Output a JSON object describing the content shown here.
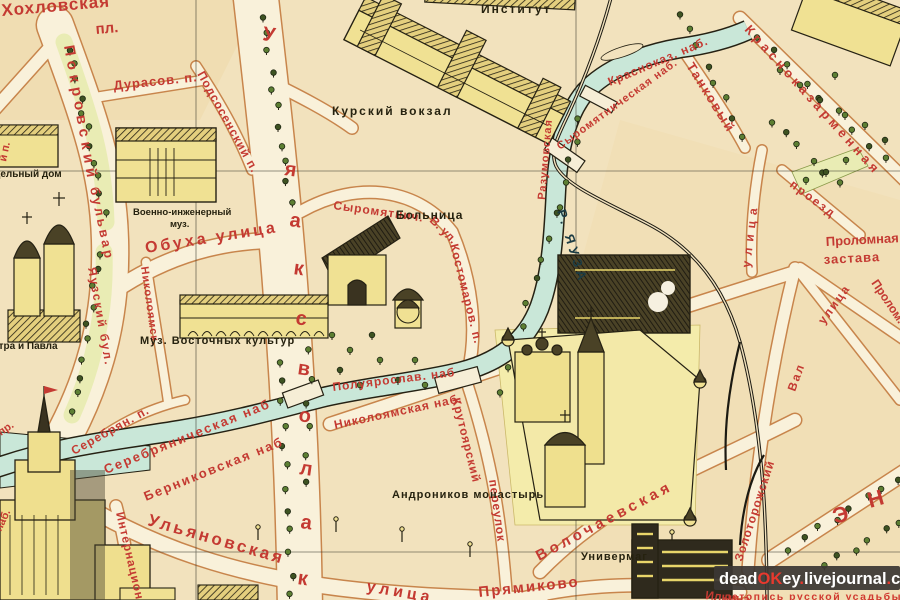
{
  "colors": {
    "paper": "#f2e2bd",
    "street_fill": "#f9f1da",
    "street_edge": "#c8854c",
    "river": "#c9e7d8",
    "ink": "#252113",
    "park": "#e9ecb4",
    "tree": "#5d7f33",
    "building": "#f0e193",
    "label_red": "#c43a32",
    "label_black": "#26220f",
    "label_blue": "#1c3c44",
    "watermark_bg": "#3b3734",
    "watermark_red": "#e8392e",
    "watermark_white": "#ffffff"
  },
  "labels": [
    {
      "t": "Хохловская",
      "x": 2,
      "y": 16,
      "s": 17,
      "r": -5,
      "ls": 1
    },
    {
      "t": "пл.",
      "x": 96,
      "y": 34,
      "s": 15,
      "r": -5
    },
    {
      "t": "Покровский",
      "x": 64,
      "y": 46,
      "s": 15,
      "r": 80,
      "ls": 5
    },
    {
      "t": "бульвар",
      "x": 90,
      "y": 188,
      "s": 13,
      "r": 78,
      "ls": 3
    },
    {
      "t": "Дурасов. п.",
      "x": 114,
      "y": 90,
      "s": 13,
      "r": -6,
      "ls": 1
    },
    {
      "t": "Подсосенский п.",
      "x": 197,
      "y": 74,
      "s": 12,
      "r": 61,
      "ls": 1
    },
    {
      "t": "й п.",
      "x": 6,
      "y": 162,
      "s": 11,
      "r": -78
    },
    {
      "t": "одельный дом",
      "x": -12,
      "y": 177,
      "s": 10,
      "c": "black"
    },
    {
      "t": "Военно-инженерный",
      "x": 133,
      "y": 215,
      "s": 9.5,
      "c": "black"
    },
    {
      "t": "муз.",
      "x": 170,
      "y": 227,
      "s": 9.5,
      "c": "black"
    },
    {
      "t": "Обуха улица",
      "x": 146,
      "y": 253,
      "s": 16,
      "r": -9,
      "ls": 3
    },
    {
      "t": "Николоямск.",
      "x": 141,
      "y": 267,
      "s": 11,
      "r": 82,
      "ls": 1
    },
    {
      "t": "Яузский бул.",
      "x": 88,
      "y": 268,
      "s": 12,
      "r": 80,
      "ls": 2
    },
    {
      "t": "Петра и Павла",
      "x": -14,
      "y": 349,
      "s": 10,
      "c": "black"
    },
    {
      "t": "Муз. Восточных культур",
      "x": 140,
      "y": 344,
      "s": 11,
      "c": "black",
      "ls": 1
    },
    {
      "t": "пр.",
      "x": 1,
      "y": 436,
      "s": 11,
      "r": -35
    },
    {
      "t": "Серебрян. п.",
      "x": 74,
      "y": 455,
      "s": 12,
      "r": -29,
      "ls": 1
    },
    {
      "t": "Серебряническая наб",
      "x": 106,
      "y": 474,
      "s": 13,
      "r": -22,
      "ls": 2
    },
    {
      "t": "Берниковская наб",
      "x": 146,
      "y": 501,
      "s": 13,
      "r": -22,
      "ls": 2
    },
    {
      "t": "наб.",
      "x": 1,
      "y": 532,
      "s": 11,
      "r": -65
    },
    {
      "t": "Интернацион.",
      "x": 116,
      "y": 513,
      "s": 12,
      "r": 77,
      "ls": 1
    },
    {
      "t": "Ульяновская",
      "x": 147,
      "y": 525,
      "s": 17,
      "r": 16,
      "ls": 3
    },
    {
      "t": "улица",
      "x": 366,
      "y": 591,
      "s": 16,
      "r": 10,
      "ls": 4
    },
    {
      "t": "У",
      "x": 262,
      "y": 40,
      "s": 20,
      "r": 8
    },
    {
      "t": "я",
      "x": 284,
      "y": 175,
      "s": 20,
      "r": 8
    },
    {
      "t": "а",
      "x": 289,
      "y": 226,
      "s": 20,
      "r": 8
    },
    {
      "t": "к",
      "x": 293,
      "y": 274,
      "s": 20,
      "r": 8
    },
    {
      "t": "с",
      "x": 295,
      "y": 324,
      "s": 20,
      "r": 8
    },
    {
      "t": "в",
      "x": 297,
      "y": 374,
      "s": 20,
      "r": 8
    },
    {
      "t": "о",
      "x": 298,
      "y": 421,
      "s": 20,
      "r": 8
    },
    {
      "t": "л",
      "x": 299,
      "y": 474,
      "s": 20,
      "r": 8
    },
    {
      "t": "а",
      "x": 300,
      "y": 528,
      "s": 20,
      "r": 8
    },
    {
      "t": "к",
      "x": 297,
      "y": 584,
      "s": 20,
      "r": 8
    },
    {
      "t": "Сыромятнич.",
      "x": 333,
      "y": 209,
      "s": 12,
      "r": 8,
      "ls": 1
    },
    {
      "t": "В. ул.",
      "x": 429,
      "y": 221,
      "s": 12,
      "r": 45
    },
    {
      "t": "Костомаров. п.",
      "x": 450,
      "y": 245,
      "s": 12,
      "r": 76,
      "ls": 1
    },
    {
      "t": "Больница",
      "x": 396,
      "y": 219,
      "s": 12,
      "c": "black",
      "ls": 1
    },
    {
      "t": "Р. ЯУЗА",
      "x": 557,
      "y": 211,
      "s": 13,
      "c": "blue",
      "r": 73,
      "ls": 4
    },
    {
      "t": "Разумовская",
      "x": 545,
      "y": 200,
      "s": 11,
      "r": -85,
      "ls": 1
    },
    {
      "t": "Сыромятническая наб.",
      "x": 560,
      "y": 150,
      "s": 11,
      "r": -36,
      "ls": 1
    },
    {
      "t": "Красноказ. наб.",
      "x": 610,
      "y": 86,
      "s": 12,
      "r": -23,
      "ls": 1
    },
    {
      "t": "Танковый",
      "x": 686,
      "y": 66,
      "s": 13,
      "r": 58,
      "ls": 2
    },
    {
      "t": "Красноказарменная",
      "x": 744,
      "y": 30,
      "s": 13,
      "r": 48,
      "ls": 4
    },
    {
      "t": "проезд",
      "x": 789,
      "y": 186,
      "s": 12,
      "r": 37,
      "ls": 2
    },
    {
      "t": "улица",
      "x": 750,
      "y": 268,
      "s": 12,
      "r": -83,
      "ls": 6
    },
    {
      "t": "Проломная",
      "x": 826,
      "y": 246,
      "s": 13,
      "r": -3
    },
    {
      "t": "застава",
      "x": 824,
      "y": 264,
      "s": 13,
      "r": -3,
      "ls": 1
    },
    {
      "t": "Пролом.",
      "x": 871,
      "y": 283,
      "s": 12,
      "r": 56
    },
    {
      "t": "улица",
      "x": 824,
      "y": 325,
      "s": 12,
      "r": -54,
      "ls": 2
    },
    {
      "t": "Вал",
      "x": 795,
      "y": 392,
      "s": 12,
      "r": -70,
      "ls": 2
    },
    {
      "t": "Золоторожский",
      "x": 742,
      "y": 562,
      "s": 12,
      "r": -72,
      "ls": 1
    },
    {
      "t": "Э",
      "x": 835,
      "y": 524,
      "s": 22,
      "r": -16
    },
    {
      "t": "Н",
      "x": 870,
      "y": 508,
      "s": 22,
      "r": -16
    },
    {
      "t": "Волочаевская",
      "x": 539,
      "y": 561,
      "s": 15,
      "r": -28,
      "ls": 4
    },
    {
      "t": "Крутоярский",
      "x": 452,
      "y": 399,
      "s": 12,
      "r": 76,
      "ls": 1
    },
    {
      "t": "переулок",
      "x": 489,
      "y": 480,
      "s": 12,
      "r": 82,
      "ls": 1
    },
    {
      "t": "Андроников монастырь",
      "x": 392,
      "y": 498,
      "s": 11,
      "c": "black",
      "ls": 1
    },
    {
      "t": "Универмаг",
      "x": 581,
      "y": 560,
      "s": 11,
      "c": "black",
      "ls": 1
    },
    {
      "t": "Прямиково",
      "x": 479,
      "y": 597,
      "s": 15,
      "r": -6,
      "ls": 2
    },
    {
      "t": "Полуярослав. наб",
      "x": 333,
      "y": 391,
      "s": 12,
      "r": -7,
      "ls": 1
    },
    {
      "t": "Николоямская наб.",
      "x": 335,
      "y": 429,
      "s": 12,
      "r": -12,
      "ls": 1
    },
    {
      "t": "Институт",
      "x": 481,
      "y": 13,
      "s": 12,
      "c": "black",
      "ls": 2
    },
    {
      "t": "Курский вокзал",
      "x": 332,
      "y": 115,
      "s": 12,
      "c": "black",
      "ls": 2
    },
    {
      "t": "Ильича",
      "x": 705,
      "y": 599,
      "s": 12,
      "r": 6
    }
  ],
  "watermark": {
    "parts": [
      {
        "t": "dead",
        "c": "#ffffff"
      },
      {
        "t": "OK",
        "c": "#e8392e"
      },
      {
        "t": "ey",
        "c": "#ffffff"
      },
      {
        "t": ".",
        "c": "#e8392e"
      },
      {
        "t": "livejournal",
        "c": "#ffffff"
      },
      {
        "t": ".",
        "c": "#e8392e"
      },
      {
        "t": "com",
        "c": "#ffffff"
      }
    ],
    "subtitle": "летопись русской усадьбы"
  }
}
